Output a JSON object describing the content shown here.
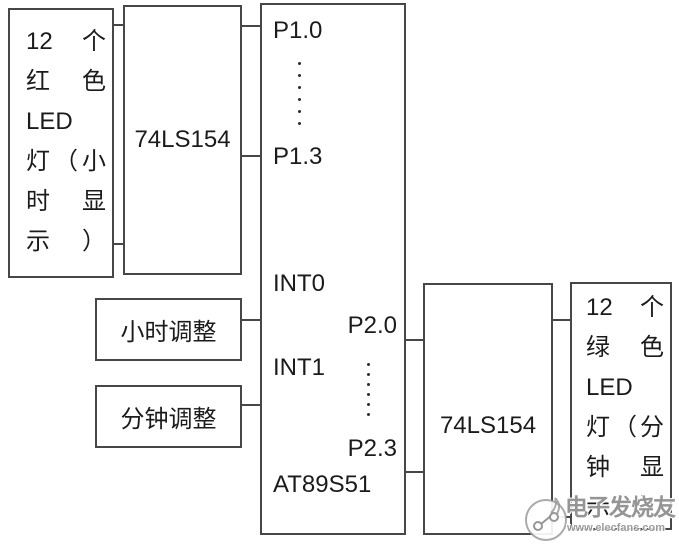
{
  "blocks": {
    "red_led": {
      "lines": [
        "12 个",
        "红色",
        "LED",
        "灯（小",
        "时 显",
        "示）"
      ]
    },
    "decoder_left": {
      "label": "74LS154"
    },
    "mcu": {
      "chip_label": "AT89S51",
      "pins": {
        "p1_0": "P1.0",
        "p1_3": "P1.3",
        "int0": "INT0",
        "int1": "INT1",
        "p2_0": "P2.0",
        "p2_3": "P2.3"
      }
    },
    "hour_adjust": {
      "label": "小时调整"
    },
    "minute_adjust": {
      "label": "分钟调整"
    },
    "decoder_right": {
      "label": "74LS154"
    },
    "green_led": {
      "lines": [
        "12 个",
        "绿 色",
        "LED",
        "灯（分",
        "钟 显",
        "示）"
      ]
    }
  },
  "watermark": {
    "brand": "电子发烧友",
    "url": "www.elecfans.com"
  },
  "colors": {
    "wire": "#474747",
    "text": "#1b1b1d",
    "watermark_gray": "#929294"
  }
}
